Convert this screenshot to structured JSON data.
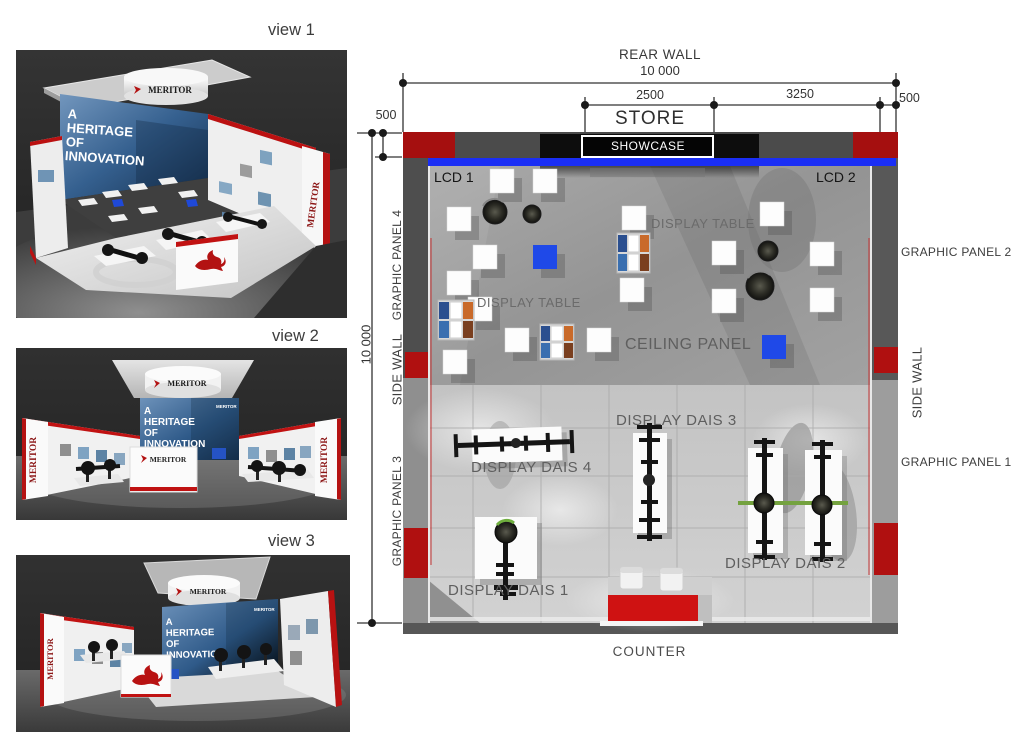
{
  "views": [
    {
      "label": "view 1"
    },
    {
      "label": "view 2"
    },
    {
      "label": "view 3"
    }
  ],
  "brand": {
    "name": "MERITOR",
    "tagline": [
      "A",
      "HERITAGE",
      "OF",
      "INNOVATION"
    ]
  },
  "plan": {
    "labels": {
      "rear_wall": "REAR WALL",
      "store": "STORE",
      "showcase": "SHOWCASE",
      "lcd_1": "LCD 1",
      "lcd_2": "LCD 2",
      "display_table": "DISPLAY TABLE",
      "ceiling_panel": "CEILING PANEL",
      "display_dais_1": "DISPLAY DAIS 1",
      "display_dais_2": "DISPLAY DAIS 2",
      "display_dais_3": "DISPLAY DAIS 3",
      "display_dais_4": "DISPLAY DAIS 4",
      "counter": "COUNTER",
      "side_wall": "SIDE WALL",
      "graphic_panel_1": "GRAPHIC PANEL 1",
      "graphic_panel_2": "GRAPHIC PANEL 2",
      "graphic_panel_3": "GRAPHIC PANEL 3",
      "graphic_panel_4": "GRAPHIC PANEL 4"
    },
    "dimensions": {
      "total_width": "10 000",
      "total_depth": "10 000",
      "store_width": "2500",
      "store_to_side": "3250",
      "side_margin_right": "500",
      "side_margin_left": "500"
    },
    "colors": {
      "accent_red": "#b01010",
      "accent_blue": "#1a2ef5",
      "wall_gray": "#4b4b4b",
      "floor_light": "#cccccc"
    }
  }
}
